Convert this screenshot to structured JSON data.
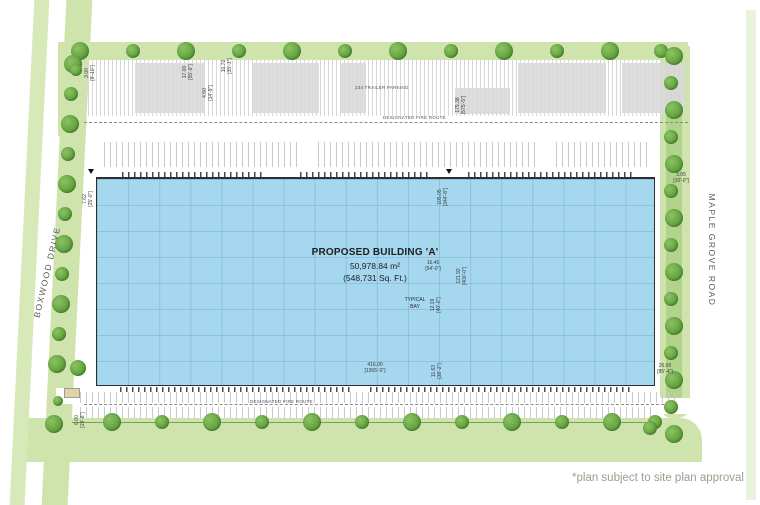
{
  "plan": {
    "building": {
      "title": "PROPOSED BUILDING 'A'",
      "area_metric": "50,978.84 m²",
      "area_imperial": "(548,731 Sq. Ft.)",
      "typical_bay_label": "TYPICAL\nBAY"
    },
    "roads": {
      "left": "BOXWOOD DRIVE",
      "right": "MAPLE GROVE ROAD"
    },
    "parking": {
      "trailer_label": "234 TRAILER PARKING",
      "fire_route_label_top": "DESIGNATED FIRE ROUTE",
      "fire_route_label_bottom": "DESIGNATED FIRE ROUTE"
    },
    "footnote": "*plan subject to site plan approval",
    "dimensions": [
      "3.00\n[9'-10\"]",
      "17.00\n[55'-9\"]",
      "4.50\n[14'-9\"]",
      "10.70\n[35'-1\"]",
      "175.38\n[575'-5\"]",
      "7.62\n[25'-0\"]",
      "105.05\n[344'-8\"]",
      "16.46\n[54'-0\"]",
      "121.92\n[400'-0\"]",
      "12.19\n[40'-0\"]",
      "416.00\n[1365'-0\"]",
      "11.63\n[38'-2\"]",
      "26.00\n[85'-4\"]",
      "3.05\n[10'-0\"]",
      "6.00\n[19'-8\"]"
    ],
    "colors": {
      "building_fill": "#a5d7ee",
      "verge_green": "#cfe4ad",
      "tree_green": "#5a9c38",
      "footnote_gray": "#96a18e"
    }
  }
}
